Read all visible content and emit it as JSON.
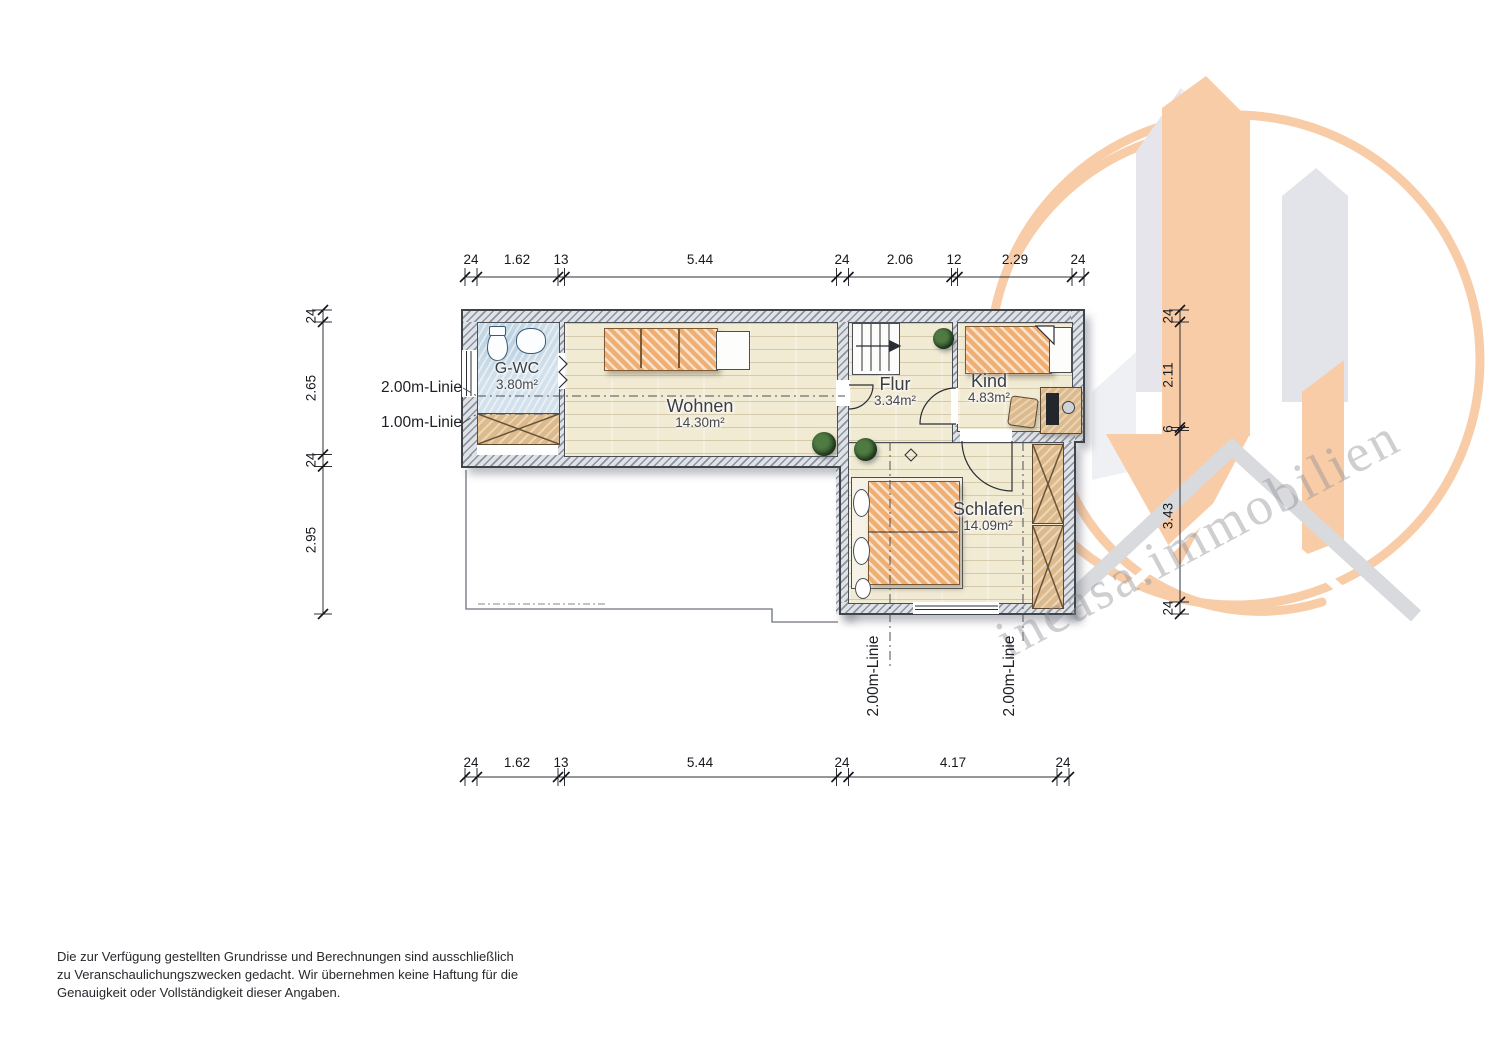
{
  "watermark": {
    "text": "incasa.immobilien",
    "orange": "#f8cca7",
    "gray": "#e6e7ec"
  },
  "colors": {
    "wall_gray": "#c3c8cf",
    "floor_cream": "#f2ebd4",
    "gwc_blue": "#d2e1eb",
    "furniture_orange": "#efae72"
  },
  "rooms": [
    {
      "id": "gwc",
      "name": "G-WC",
      "area": "3.80m²"
    },
    {
      "id": "wohnen",
      "name": "Wohnen",
      "area": "14.30m²"
    },
    {
      "id": "flur",
      "name": "Flur",
      "area": "3.34m²"
    },
    {
      "id": "kind",
      "name": "Kind",
      "area": "4.83m²"
    },
    {
      "id": "schlafen",
      "name": "Schlafen",
      "area": "14.09m²"
    }
  ],
  "height_lines": {
    "left_2m": "2.00m-Linie",
    "left_1m": "1.00m-Linie",
    "bottom_left_2m": "2.00m-Linie",
    "bottom_right_2m": "2.00m-Linie"
  },
  "dimensions": {
    "top": [
      "24",
      "1.62",
      "13",
      "5.44",
      "24",
      "2.06",
      "12",
      "2.29",
      "24"
    ],
    "bottom": [
      "24",
      "1.62",
      "13",
      "5.44",
      "24",
      "4.17",
      "24"
    ],
    "left": [
      "24",
      "2.65",
      "24",
      "2.95"
    ],
    "right": [
      "24",
      "2.11",
      "6",
      "3.43",
      "24"
    ]
  },
  "disclaimer": {
    "line1": "Die zur Verfügung gestellten Grundrisse und Berechnungen sind ausschließlich",
    "line2": "zu Veranschaulichungszwecken gedacht. Wir übernehmen keine Haftung für die",
    "line3": "Genauigkeit oder Vollständigkeit dieser Angaben."
  }
}
